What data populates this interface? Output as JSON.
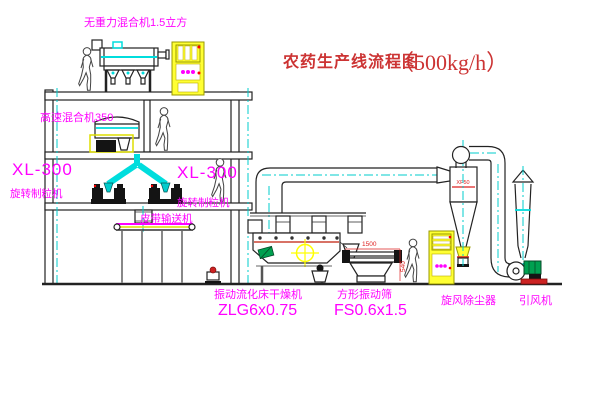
{
  "title": {
    "name_cn": "农药生产线流程图",
    "capacity": "（500kg/h）"
  },
  "equipment_labels": {
    "gravity_mixer": "无重力混合机1.5立方",
    "high_speed_mixer": "高速混合机350",
    "granulator_left": {
      "model": "XL-300",
      "name": "旋转制粒机"
    },
    "granulator_right": {
      "model": "XL-300",
      "name": "旋转制粒机"
    },
    "belt_conveyor": "皮带输送机",
    "fluid_bed_dryer": {
      "name": "振动流化床干燥机",
      "model": "ZLG6x0.75"
    },
    "vibrating_screen": {
      "name": "方形振动筛",
      "model": "FS0.6x1.5"
    },
    "cyclone": "旋风除尘器",
    "induced_draft_fan": "引风机"
  },
  "dimensions": {
    "screen_width": "1500",
    "screen_height": "540",
    "cyclone_mark": "XF50"
  },
  "icons": {
    "control_knobs": "three magenta knobs on cabinet",
    "indicator_light": "red dot lamp",
    "centerline_target": "yellow circle-crosshair centerline symbol",
    "person_figure": "worker silhouette"
  },
  "colors": {
    "line": "#222222",
    "cyan": "#00dddd",
    "centerline_cyan": "#00cccc",
    "magenta": "#ff00ff",
    "title_red": "#cc3333",
    "dim_red": "#dd2222",
    "cabinet_yellow": "#ffff33",
    "motor_green": "#00a050",
    "base_red": "#cc2222"
  }
}
